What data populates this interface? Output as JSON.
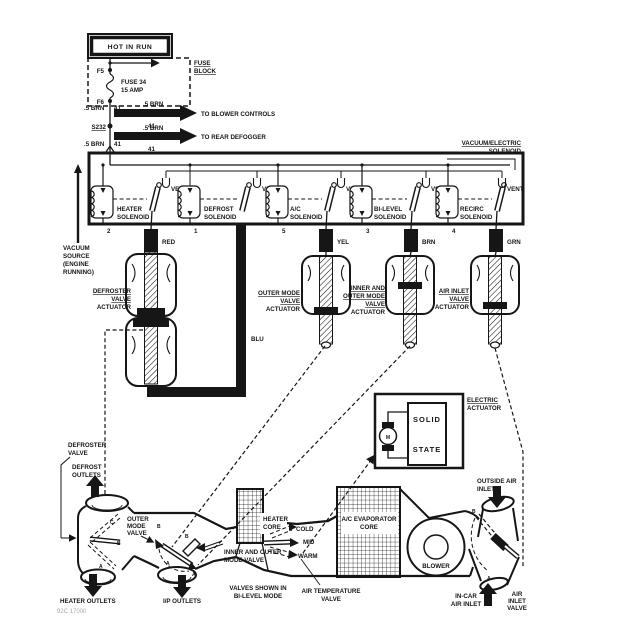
{
  "power": {
    "hot_in_run": "HOT IN RUN",
    "fuse_block": [
      "FUSE",
      "BLOCK"
    ],
    "fuse": [
      "FUSE 34",
      "15 AMP"
    ],
    "terminal_top": "F5",
    "terminal_bottom": "F6",
    "wire": ".5 BRN",
    "circuit": "41",
    "splice": "S232",
    "to_blower_controls": "TO BLOWER CONTROLS",
    "to_rear_defogger": "TO REAR DEFOGGER"
  },
  "solenoid_box": {
    "title": [
      "VACUUM/ELECTRIC",
      "SOLENOID"
    ],
    "vent": "VENT",
    "units": [
      {
        "name": [
          "HEATER",
          "SOLENOID"
        ],
        "terminal": "2",
        "hose": "RED"
      },
      {
        "name": [
          "DEFROST",
          "SOLENOID"
        ],
        "terminal": "1",
        "hose": "BLU"
      },
      {
        "name": [
          "A/C",
          "SOLENOID"
        ],
        "terminal": "5",
        "hose": "YEL"
      },
      {
        "name": [
          "BI-LEVEL",
          "SOLENOID"
        ],
        "terminal": "3",
        "hose": "BRN"
      },
      {
        "name": [
          "RECIRC",
          "SOLENOID"
        ],
        "terminal": "4",
        "hose": "GRN"
      }
    ],
    "vacuum_source": [
      "VACUUM",
      "SOURCE",
      "(ENGINE",
      "RUNNING)"
    ]
  },
  "actuators": {
    "defroster": [
      "DEFROSTER",
      "VALVE",
      "ACTUATOR"
    ],
    "outer_mode": [
      "OUTER MODE",
      "VALVE",
      "ACTUATOR"
    ],
    "inner_outer": [
      "INNER AND",
      "OUTER MODE",
      "VALVE",
      "ACTUATOR"
    ],
    "air_inlet": [
      "AIR INLET",
      "VALVE",
      "ACTUATOR"
    ],
    "electric": [
      "ELECTRIC",
      "ACTUATOR"
    ],
    "solid_state": [
      "SOLID",
      "STATE"
    ],
    "motor": "M"
  },
  "hvac": {
    "defroster_valve": [
      "DEFROSTER",
      "VALVE"
    ],
    "defrost_outlets": [
      "DEFROST",
      "OUTLETS"
    ],
    "heater_outlets": "HEATER OUTLETS",
    "ip_outlets": "I/P OUTLETS",
    "outer_mode_valve": [
      "OUTER",
      "MODE",
      "VALVE"
    ],
    "inner_outer_valve": [
      "INNER AND OUTER",
      "MODE VALVE"
    ],
    "valves_note": [
      "VALVES SHOWN IN",
      "BI-LEVEL MODE"
    ],
    "heater_core": [
      "HEATER",
      "CORE"
    ],
    "temp_positions": {
      "cold": "COLD",
      "mid": "MID",
      "warm": "WARM"
    },
    "air_temp_valve": [
      "AIR TEMPERATURE",
      "VALVE"
    ],
    "evaporator": [
      "A/C EVAPORATOR",
      "CORE"
    ],
    "blower": "BLOWER",
    "outside_air_inlet": [
      "OUTSIDE AIR",
      "INLET"
    ],
    "in_car_air_inlet": [
      "IN-CAR",
      "AIR INLET"
    ],
    "air_inlet_valve": [
      "AIR",
      "INLET",
      "VALVE"
    ],
    "position_letters": [
      "C",
      "B",
      "A",
      "B",
      "A",
      "B",
      "A",
      "B",
      "A"
    ]
  },
  "caption": "92C 17000"
}
